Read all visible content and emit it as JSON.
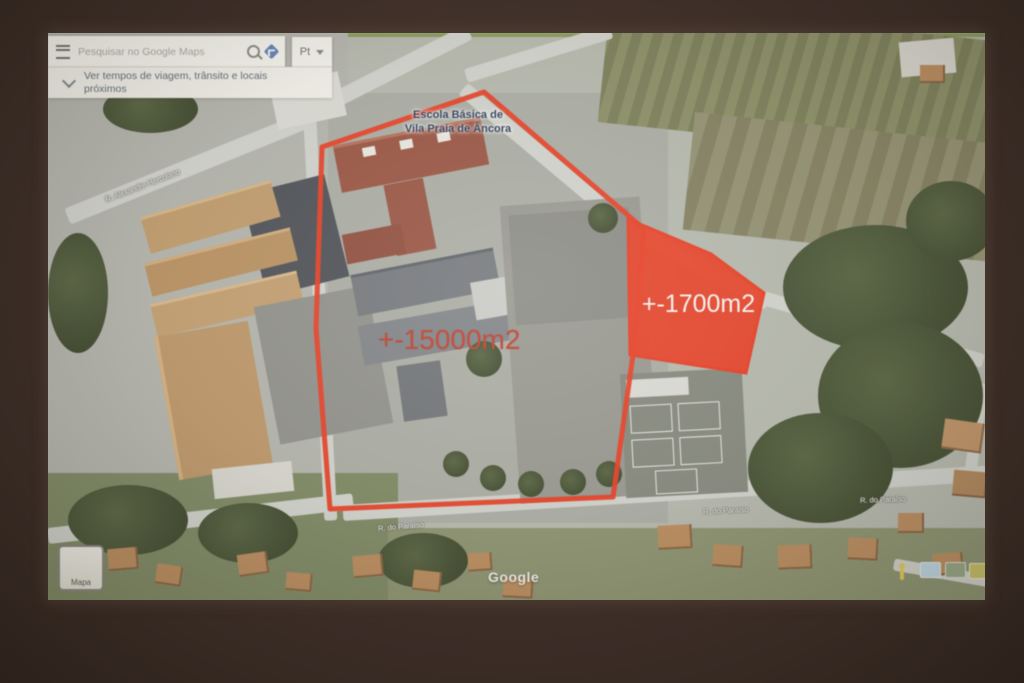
{
  "colors": {
    "overlay_red": "#e8432a",
    "area_label_red": "#d63a22",
    "school_label_navy": "#2a3a60",
    "wall_brown": "#3e2e27",
    "panel_white": "#f5f3ec",
    "directions_blue": "#5d83c4",
    "pegman_yellow": "#e8c83c",
    "field_olive": "#8a8e5c",
    "tree_green": "#44522e"
  },
  "icons": {
    "menu": "hamburger-icon",
    "search": "magnifier-icon",
    "directions": "diamond-icon",
    "caret": "caret-down-icon",
    "chevron": "chevron-down-icon",
    "pegman": "pegman-icon"
  },
  "search_panel": {
    "placeholder": "Pesquisar no Google Maps",
    "language_control": {
      "label": "Pt"
    },
    "suggestion": {
      "text": "Ver tempos de viagem, trânsito e locais próximos"
    }
  },
  "map": {
    "school_label": {
      "line1": "Escola Básica de",
      "line2": "Vila Praia de Âncora"
    },
    "annotations": {
      "large_area": "+-15000m2",
      "small_area": "+-1700m2"
    },
    "street_labels": [
      "R. Alexandre Herculano",
      "R. do Paraíso",
      "R. do Paraíso",
      "R. do Paraíso"
    ],
    "watermark": "Google",
    "map_type_toggle": "Mapa"
  }
}
